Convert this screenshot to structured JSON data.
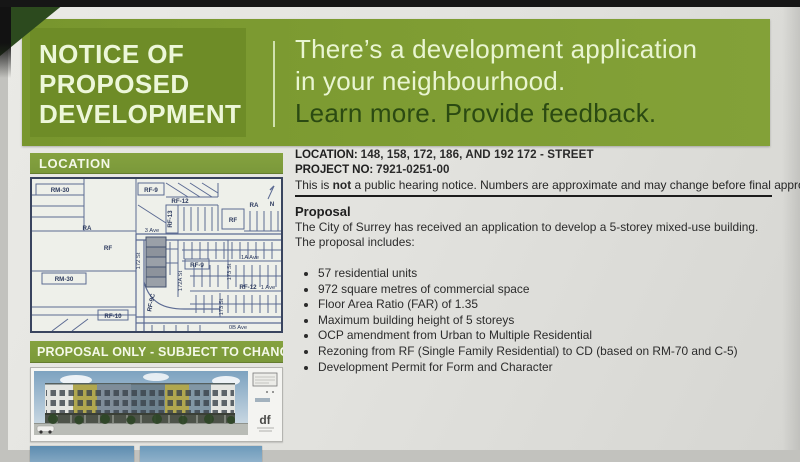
{
  "header": {
    "title_line1": "NOTICE OF",
    "title_line2": "PROPOSED",
    "title_line3": "DEVELOPMENT",
    "message_line1": "There’s a development application",
    "message_line2": "in your neighbourhood.",
    "message_line3": "Learn more. Provide feedback."
  },
  "left": {
    "location_bar": "LOCATION",
    "proposal_bar": "PROPOSAL ONLY - SUBJECT TO CHANGE",
    "map_labels": [
      "RM-30",
      "RF-9",
      "RF-12",
      "RA",
      "N",
      "RF-13",
      "RF",
      "RA",
      "3 Ave",
      "RF",
      "RM-30",
      "RF-10",
      "172 St",
      "RF-9C",
      "172A St",
      "RF-9",
      "1A Ave",
      "173 St",
      "RF-12",
      "1 Ave",
      "173 St",
      "0B Ave"
    ],
    "rendering_logo": "df"
  },
  "details": {
    "location_label": "LOCATION:",
    "location_value": "148, 158, 172, 186, AND 192 172 - STREET",
    "project_label": "PROJECT NO:",
    "project_value": "7921-0251-00",
    "notice_pre": "This is ",
    "notice_bold": "not",
    "notice_post": " a public hearing notice. Numbers are approximate and may change before final approval.",
    "proposal_heading": "Proposal",
    "proposal_intro": "The City of Surrey has received an application to develop a 5-storey mixed-use building.  The proposal includes:",
    "bullets": [
      "57 residential units",
      "972 square metres of commercial space",
      "Floor Area Ratio (FAR) of 1.35",
      "Maximum building height of 5 storeys",
      "OCP amendment from Urban to Multiple Residential",
      "Rezoning from RF (Single Family Residential) to CD (based on RM-70 and C-5)",
      "Development Permit for Form and Character"
    ]
  },
  "colors": {
    "band_green": "#7f9d33",
    "band_green_dark": "#6e8c27",
    "pale_green_text": "#edf7d9",
    "dark_green_text": "#2b4a12",
    "map_line_blue": "#5c6b93"
  }
}
